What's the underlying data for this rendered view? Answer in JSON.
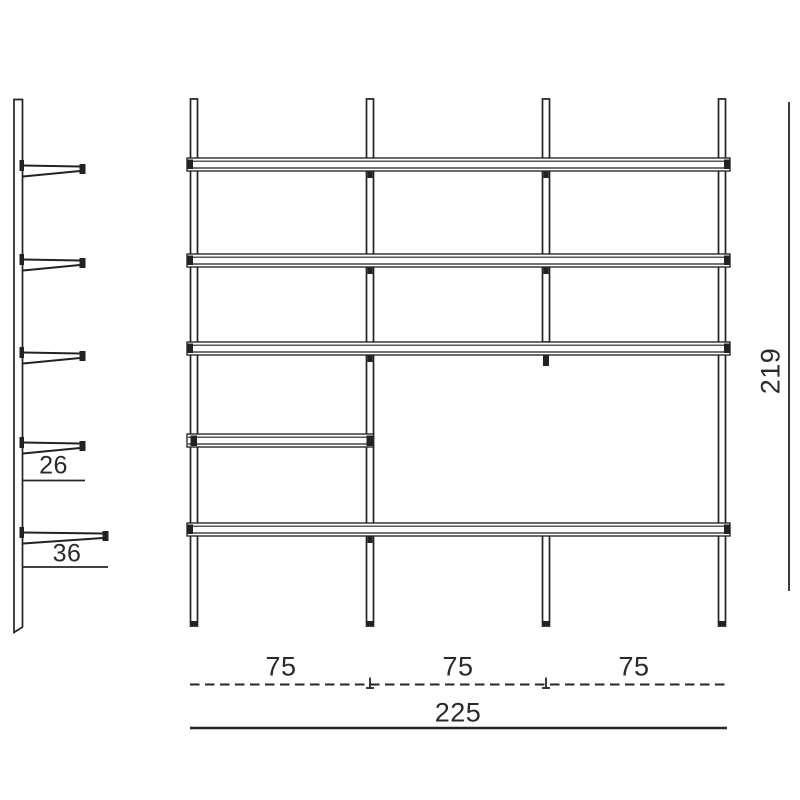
{
  "labels": {
    "side": {
      "upper_depth": "26",
      "lower_depth": "36"
    },
    "bottom": {
      "bays": [
        "75",
        "75",
        "75"
      ],
      "total_width": "225"
    },
    "right": {
      "total_height": "219"
    }
  },
  "colors": {
    "line": "#222222",
    "text": "#2a2a2a",
    "background": "#ffffff"
  }
}
